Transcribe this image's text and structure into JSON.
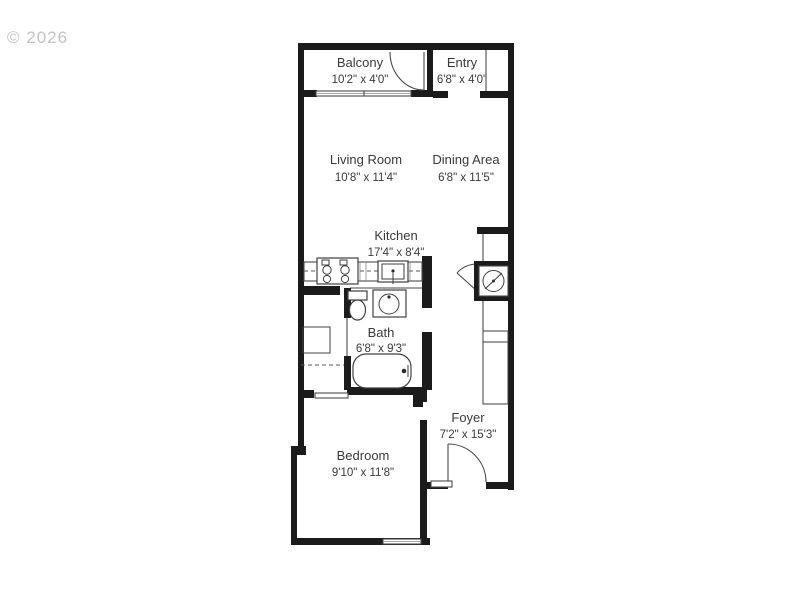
{
  "watermark": "© 2026",
  "colors": {
    "background": "#ffffff",
    "wall": "#1b1b1b",
    "thin_line": "#4a4a4a",
    "room_text": "#3a3a3a",
    "watermark_text": "#c3c3c3"
  },
  "rooms": [
    {
      "id": "balcony",
      "name": "Balcony",
      "dims": "10'2\" x 4'0\""
    },
    {
      "id": "entry",
      "name": "Entry",
      "dims": "6'8\" x 4'0\""
    },
    {
      "id": "living-room",
      "name": "Living Room",
      "dims": "10'8\" x 11'4\""
    },
    {
      "id": "dining-area",
      "name": "Dining Area",
      "dims": "6'8\" x 11'5\""
    },
    {
      "id": "kitchen",
      "name": "Kitchen",
      "dims": "17'4\" x 8'4\""
    },
    {
      "id": "bath",
      "name": "Bath",
      "dims": "6'8\" x 9'3\""
    },
    {
      "id": "foyer",
      "name": "Foyer",
      "dims": "7'2\" x 15'3\""
    },
    {
      "id": "bedroom",
      "name": "Bedroom",
      "dims": "9'10\" x 11'8\""
    }
  ],
  "icons": [
    "stove-icon",
    "kitchen-sink-icon",
    "bath-sink-icon",
    "toilet-icon",
    "bathtub-icon",
    "washer-dryer-icon",
    "door-swing-icon",
    "window-icon",
    "sliding-door-icon",
    "closet-shelf-icon"
  ]
}
